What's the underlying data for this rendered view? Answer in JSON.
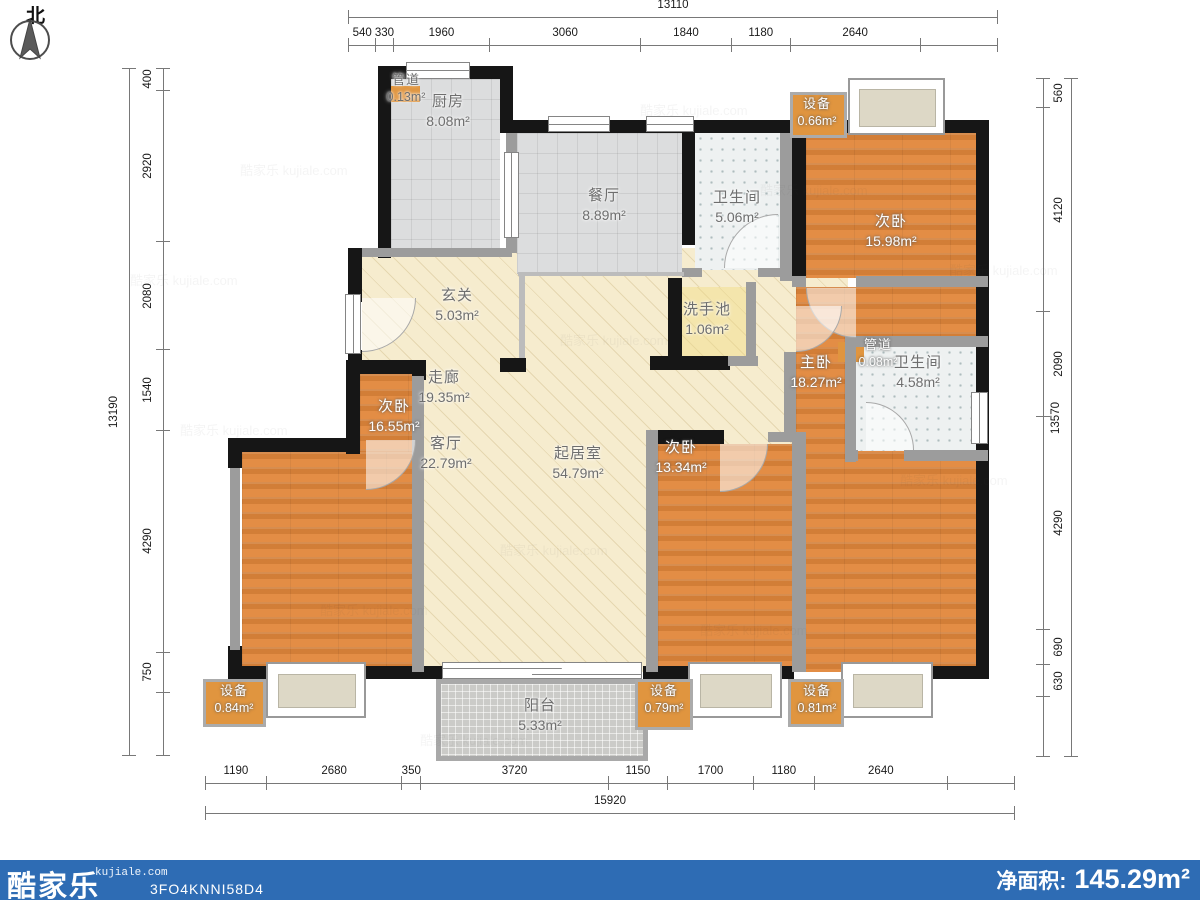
{
  "meta": {
    "compass_label": "北",
    "watermark": "酷家乐 kujiale.com",
    "brand": "酷家乐",
    "brand_site": "kujiale.com",
    "plan_code": "3FO4KNNI58D4",
    "net_area_label": "净面积:",
    "net_area_value": "145.29m²",
    "bar_color": "#2e6cb4",
    "wood_color": "#e2873b",
    "equip_color": "#e0953f"
  },
  "rooms": {
    "kitchen": {
      "name": "厨房",
      "area": "8.08m²"
    },
    "pipe_top": {
      "name": "管道",
      "area": "0.13m²"
    },
    "dining": {
      "name": "餐厅",
      "area": "8.89m²"
    },
    "bath_top": {
      "name": "卫生间",
      "area": "5.06m²"
    },
    "equip_top": {
      "name": "设备",
      "area": "0.66m²"
    },
    "bed_top_right": {
      "name": "次卧",
      "area": "15.98m²"
    },
    "foyer": {
      "name": "玄关",
      "area": "5.03m²"
    },
    "washbasin": {
      "name": "洗手池",
      "area": "1.06m²"
    },
    "corridor": {
      "name": "走廊",
      "area": "19.35m²"
    },
    "bed_left": {
      "name": "次卧",
      "area": "16.55m²"
    },
    "living": {
      "name": "客厅",
      "area": "22.79m²"
    },
    "family": {
      "name": "起居室",
      "area": "54.79m²"
    },
    "bed_mid": {
      "name": "次卧",
      "area": "13.34m²"
    },
    "master": {
      "name": "主卧",
      "area": "18.27m²"
    },
    "pipe_right": {
      "name": "管道",
      "area": "0.08m²"
    },
    "bath_master": {
      "name": "卫生间",
      "area": "4.58m²"
    },
    "equip_left": {
      "name": "设备",
      "area": "0.84m²"
    },
    "balcony": {
      "name": "阳台",
      "area": "5.33m²"
    },
    "equip_mid": {
      "name": "设备",
      "area": "0.79m²"
    },
    "equip_right": {
      "name": "设备",
      "area": "0.81m²"
    }
  },
  "dimensions": {
    "top": {
      "total": "13110",
      "segments": [
        "540",
        "330",
        "1960",
        "3060",
        "1840",
        "1180",
        "2640"
      ]
    },
    "bottom": {
      "total": "15920",
      "segments": [
        "1190",
        "2680",
        "350",
        "3720",
        "1150",
        "1700",
        "1180",
        "2640"
      ]
    },
    "left": {
      "total": "13190",
      "segments": [
        "400",
        "2920",
        "2080",
        "1540",
        "4290",
        "750"
      ]
    },
    "right": {
      "total": "13570",
      "segments": [
        "560",
        "4120",
        "2090",
        "4290",
        "690",
        "630"
      ]
    }
  }
}
